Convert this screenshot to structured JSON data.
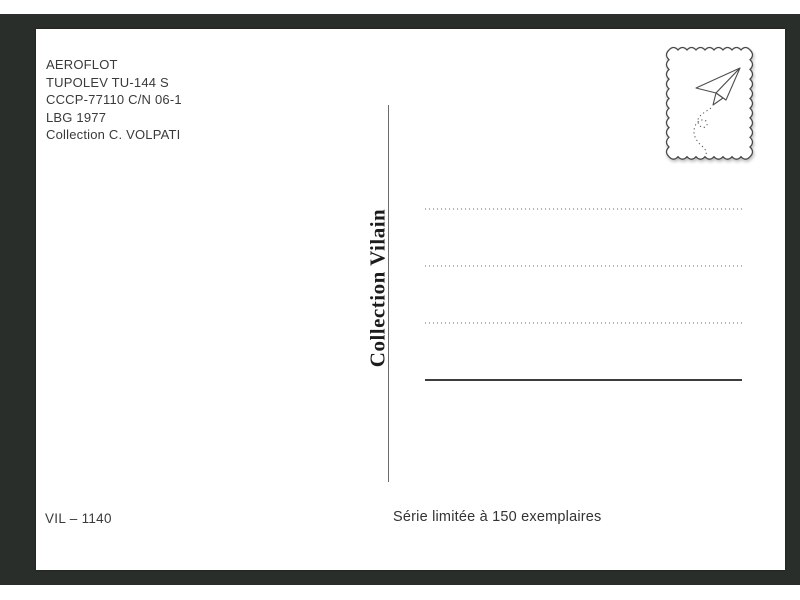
{
  "postcard": {
    "info_block": {
      "lines": [
        "AEROFLOT",
        "TUPOLEV TU-144 S",
        "CCCP-77110 C/N 06-1",
        "LBG 1977",
        "Collection C. VOLPATI"
      ]
    },
    "publisher_vertical_text": "Collection Vilain",
    "stamp": {
      "icon": "paper-plane-icon"
    },
    "address_block": {
      "dotted_lines": 3,
      "solid_lines": 1
    },
    "footer": {
      "reference": "VIL – 1140",
      "edition": "Série limitée à 150 exemplaires"
    },
    "colors": {
      "mat": "#2a2e2a",
      "card": "#ffffff",
      "text": "#3a3a3a",
      "dotted_line": "#b3b3b3",
      "solid_line": "#3d3d3d",
      "divider": "#6b6b6b",
      "stamp_outline": "#4a4a4a"
    }
  }
}
